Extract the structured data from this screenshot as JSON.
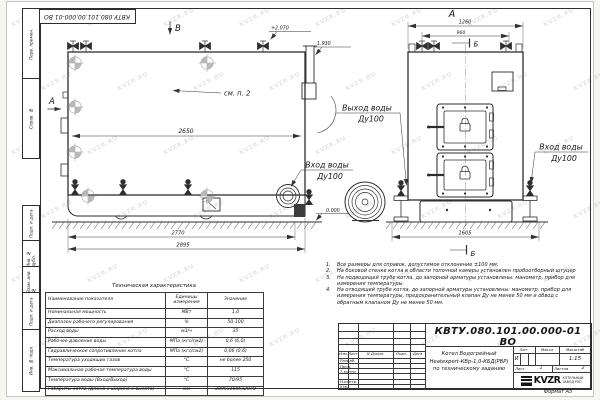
{
  "watermark": {
    "text": "KVZR.RU"
  },
  "stamp_top": "КВТУ.080.101.00.000-01  ВО",
  "frame_labels": [
    "Перв. примен.",
    "Справ. №",
    "Подп. и дата",
    "Инв. № дубл.",
    "Взам. инв. №",
    "Подп. и дата",
    "Инв. № подл."
  ],
  "drawing": {
    "side_view": {
      "view_mark": "В",
      "dir_mark": "А",
      "note_ref": "см. п. 2",
      "dim_inner": "2650",
      "dim_base": "2770",
      "dim_total": "2895",
      "elev_top": "+2.070",
      "elev_mid": "1.930",
      "elev_zero": "0.000",
      "outlet_line1": "Выход воды",
      "outlet_line2": "Ду100",
      "inlet_line1": "Вход воды",
      "inlet_line2": "Ду100"
    },
    "front_view": {
      "title": "А",
      "dim_width": "1260",
      "dim_width2": "960",
      "dim_base": "1605",
      "section_top": "Б",
      "section_bottom": "Б",
      "inlet_line1": "Вход воды",
      "inlet_line2": "Ду100"
    }
  },
  "notes": [
    {
      "n": "1.",
      "text": "Все размеры для справок, допустимое отклонение ±100 мм."
    },
    {
      "n": "2.",
      "text": "На боковой стенке котла в области топочной камеры установлен пробоотборный штуцер"
    },
    {
      "n": "3.",
      "text": "На  подводящей трубе котла, до запорной арматуры установлены: манометр, прибор для измерения температуры."
    },
    {
      "n": "4.",
      "text": "На отводящей трубе котла, до запорной арматуры установлены: манометр, прибор для измерения температуры, предохранительный клапан Ду не менее 50 мм и обвод с обратным клапаном Ду не менее 50 мм."
    }
  ],
  "table": {
    "title": "Техническая характеристика",
    "headers": [
      "Наименование показателя",
      "Единицы измерения",
      "Значение"
    ],
    "rows": [
      [
        "Номинальная мощность",
        "МВт",
        "1,0"
      ],
      [
        "Диапазон рабочего регулирования",
        "%",
        "50-100"
      ],
      [
        "Расход воды",
        "м3/ч",
        "35"
      ],
      [
        "Рабочее давление воды",
        "МПа (кгс/см2)",
        "0,6 (6,0)"
      ],
      [
        "Гидравлическое сопротивление котла",
        "МПа (кгс/см2)",
        "0,06 (0,6)"
      ],
      [
        "Температура уходящих газов",
        "°С",
        "не более 250"
      ],
      [
        "Максимальная рабочая температура воды",
        "°С",
        "115"
      ],
      [
        "Температура воды (Вход/Выход)",
        "°С",
        "70/95"
      ],
      [
        "Габариты котла (Длина х ширина х высота)",
        "мм",
        "2895х1605х2070"
      ]
    ]
  },
  "titleblock": {
    "doc_number": "КВТУ.080.101.00.000-01  ВО",
    "title_line1": "Котел Водогрейный",
    "title_line2": "Heatexpert-КВр-1,0-КБД(РВР)",
    "title_line3": "по техническому заданию",
    "rev_cols": [
      "Изм.",
      "Лист",
      "N Докум.",
      "Подп.",
      "Дата"
    ],
    "sig_rows": [
      "Разраб.",
      "Пров.",
      "Т.контр.",
      "",
      "Н.контр.",
      "Утв."
    ],
    "lit_label": "Лит.",
    "lit_value": "И",
    "mass_label": "Масса",
    "scale_label": "Масштаб",
    "scale_value": "1:15",
    "sheet_label": "Лист",
    "sheet_value": "1",
    "sheets_label": "Листов",
    "sheets_value": "2",
    "logo_text": "KVZR",
    "logo_sub1": "КОТЕЛЬНЫЙ",
    "logo_sub2": "ЗАВОД РЭП",
    "format_label": "Формат  А3"
  }
}
